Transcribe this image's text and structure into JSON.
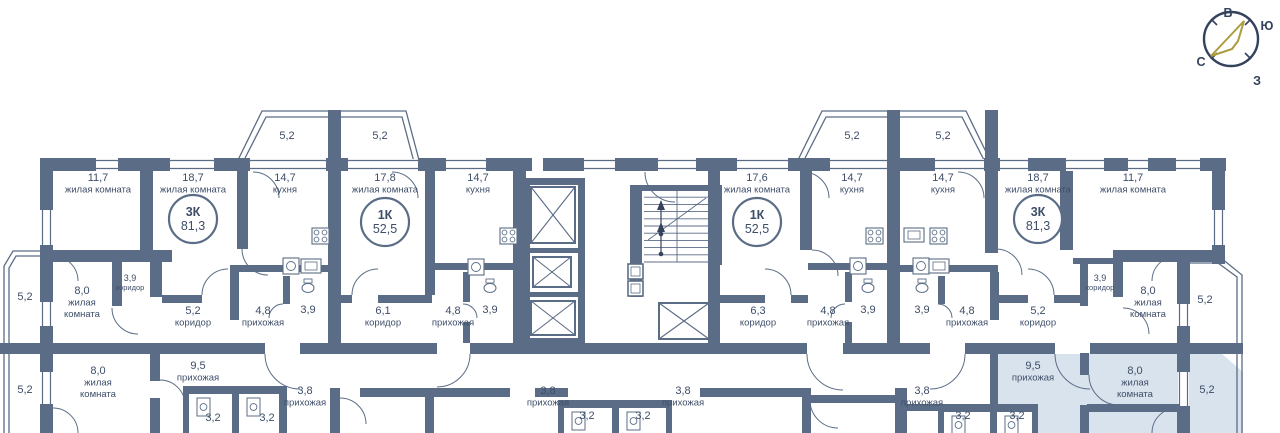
{
  "colors": {
    "wall": "#5b6d86",
    "text": "#3e4d68",
    "highlight": "#d9e3ee",
    "gold": "#ac9c3d",
    "compass": "#34425c",
    "white": "#ffffff"
  },
  "compass": {
    "cx": 1231,
    "cy": 39,
    "r": 27,
    "letters": [
      {
        "t": "В",
        "x": 1228,
        "y": 17
      },
      {
        "t": "Ю",
        "x": 1267,
        "y": 30
      },
      {
        "t": "С",
        "x": 1201,
        "y": 66
      },
      {
        "t": "З",
        "x": 1257,
        "y": 85
      }
    ],
    "ticks": [
      [
        1245,
        25,
        1251,
        19
      ],
      [
        1217,
        25,
        1211,
        19
      ],
      [
        1245,
        53,
        1251,
        59
      ],
      [
        1217,
        53,
        1211,
        59
      ]
    ],
    "arrow": "M1244,21 L1211,56 L1232,49 L1238,41 Z"
  },
  "apartments": [
    {
      "type": "3К",
      "area": "81,3",
      "cx": 193,
      "cy": 219
    },
    {
      "type": "1К",
      "area": "52,5",
      "cx": 385,
      "cy": 222
    },
    {
      "type": "1К",
      "area": "52,5",
      "cx": 757,
      "cy": 222
    },
    {
      "type": "3К",
      "area": "81,3",
      "cx": 1038,
      "cy": 219
    }
  ],
  "rooms": [
    {
      "x": 287,
      "y": 139,
      "l": [
        "5,2"
      ]
    },
    {
      "x": 380,
      "y": 139,
      "l": [
        "5,2"
      ]
    },
    {
      "x": 852,
      "y": 139,
      "l": [
        "5,2"
      ]
    },
    {
      "x": 943,
      "y": 139,
      "l": [
        "5,2"
      ]
    },
    {
      "x": 98,
      "y": 181,
      "l": [
        "11,7",
        "жилая комната"
      ]
    },
    {
      "x": 193,
      "y": 181,
      "l": [
        "18,7",
        "жилая комната"
      ]
    },
    {
      "x": 285,
      "y": 181,
      "l": [
        "14,7",
        "кухня"
      ]
    },
    {
      "x": 385,
      "y": 181,
      "l": [
        "17,8",
        "жилая комната"
      ]
    },
    {
      "x": 478,
      "y": 181,
      "l": [
        "14,7",
        "кухня"
      ]
    },
    {
      "x": 757,
      "y": 181,
      "l": [
        "17,6",
        "жилая комната"
      ]
    },
    {
      "x": 852,
      "y": 181,
      "l": [
        "14,7",
        "кухня"
      ]
    },
    {
      "x": 943,
      "y": 181,
      "l": [
        "14,7",
        "кухня"
      ]
    },
    {
      "x": 1038,
      "y": 181,
      "l": [
        "18,7",
        "жилая комната"
      ]
    },
    {
      "x": 1133,
      "y": 181,
      "l": [
        "11,7",
        "жилая комната"
      ]
    },
    {
      "x": 25,
      "y": 300,
      "l": [
        "5,2"
      ]
    },
    {
      "x": 82,
      "y": 294,
      "l": [
        "8,0",
        "жилая",
        "комната"
      ]
    },
    {
      "x": 130,
      "y": 281,
      "l": [
        "3,9",
        "коридор"
      ],
      "s": 1
    },
    {
      "x": 193,
      "y": 314,
      "l": [
        "5,2",
        "коридор"
      ]
    },
    {
      "x": 263,
      "y": 314,
      "l": [
        "4,8",
        "прихожая"
      ]
    },
    {
      "x": 308,
      "y": 313,
      "l": [
        "3,9"
      ]
    },
    {
      "x": 383,
      "y": 314,
      "l": [
        "6,1",
        "коридор"
      ]
    },
    {
      "x": 453,
      "y": 314,
      "l": [
        "4,8",
        "прихожая"
      ]
    },
    {
      "x": 490,
      "y": 313,
      "l": [
        "3,9"
      ]
    },
    {
      "x": 758,
      "y": 314,
      "l": [
        "6,3",
        "коридор"
      ]
    },
    {
      "x": 828,
      "y": 314,
      "l": [
        "4,8",
        "прихожая"
      ]
    },
    {
      "x": 868,
      "y": 313,
      "l": [
        "3,9"
      ]
    },
    {
      "x": 922,
      "y": 313,
      "l": [
        "3,9"
      ]
    },
    {
      "x": 967,
      "y": 314,
      "l": [
        "4,8",
        "прихожая"
      ]
    },
    {
      "x": 1038,
      "y": 314,
      "l": [
        "5,2",
        "коридор"
      ]
    },
    {
      "x": 1100,
      "y": 281,
      "l": [
        "3,9",
        "коридор"
      ],
      "s": 1
    },
    {
      "x": 1148,
      "y": 294,
      "l": [
        "8,0",
        "жилая",
        "комната"
      ]
    },
    {
      "x": 1205,
      "y": 303,
      "l": [
        "5,2"
      ]
    },
    {
      "x": 25,
      "y": 393,
      "l": [
        "5,2"
      ]
    },
    {
      "x": 98,
      "y": 374,
      "l": [
        "8,0",
        "жилая",
        "комната"
      ]
    },
    {
      "x": 198,
      "y": 369,
      "l": [
        "9,5",
        "прихожая"
      ]
    },
    {
      "x": 213,
      "y": 421,
      "l": [
        "3,2"
      ]
    },
    {
      "x": 267,
      "y": 421,
      "l": [
        "3,2"
      ]
    },
    {
      "x": 305,
      "y": 394,
      "l": [
        "3,8",
        "прихожая"
      ]
    },
    {
      "x": 548,
      "y": 394,
      "l": [
        "3,8",
        "прихожая"
      ]
    },
    {
      "x": 587,
      "y": 419,
      "l": [
        "3,2"
      ]
    },
    {
      "x": 643,
      "y": 419,
      "l": [
        "3,2"
      ]
    },
    {
      "x": 683,
      "y": 394,
      "l": [
        "3,8",
        "прихожая"
      ]
    },
    {
      "x": 922,
      "y": 394,
      "l": [
        "3,8",
        "прихожая"
      ]
    },
    {
      "x": 963,
      "y": 419,
      "l": [
        "3,2"
      ]
    },
    {
      "x": 1017,
      "y": 419,
      "l": [
        "3,2"
      ]
    },
    {
      "x": 1033,
      "y": 369,
      "l": [
        "9,5",
        "прихожая"
      ]
    },
    {
      "x": 1135,
      "y": 374,
      "l": [
        "8,0",
        "жилая",
        "комната"
      ]
    },
    {
      "x": 1207,
      "y": 393,
      "l": [
        "5,2"
      ]
    }
  ],
  "plan": {
    "highlight": "M990,354 L1222,354 L1243,372 L1243,433 L990,433 Z",
    "outlines": [
      "M238,160 L262,111 L406,111 L419,160",
      "M243,162 L266,117 L402,117 L414,162",
      "M798,160 L822,111 L966,111 L990,160",
      "M803,162 L826,117 L962,117 L985,162",
      "M43,251 L13,251 L4,266 L4,433",
      "M43,256 L16,256 L9,268 L9,433",
      "M1188,258 L1221,258 L1242,275 L1242,433",
      "M1188,263 L1218,263 L1237,277 L1237,433"
    ],
    "windows": [
      [
        96,
        159,
        22,
        11
      ],
      [
        170,
        159,
        44,
        11
      ],
      [
        250,
        159,
        76,
        11
      ],
      [
        348,
        159,
        70,
        11
      ],
      [
        446,
        159,
        40,
        11
      ],
      [
        584,
        159,
        31,
        11
      ],
      [
        658,
        159,
        38,
        11
      ],
      [
        737,
        159,
        51,
        11
      ],
      [
        830,
        159,
        60,
        11
      ],
      [
        935,
        159,
        49,
        11
      ],
      [
        1000,
        159,
        28,
        11
      ],
      [
        1066,
        159,
        38,
        11
      ],
      [
        1128,
        159,
        20,
        11
      ],
      [
        1176,
        159,
        24,
        11
      ],
      [
        41,
        210,
        11,
        36
      ],
      [
        41,
        297,
        11,
        29
      ],
      [
        41,
        372,
        11,
        32
      ],
      [
        1213,
        210,
        11,
        35
      ],
      [
        1178,
        304,
        11,
        22
      ],
      [
        1178,
        372,
        11,
        34
      ]
    ],
    "walls": [
      [
        40,
        158,
        56,
        13
      ],
      [
        118,
        158,
        52,
        13
      ],
      [
        214,
        158,
        36,
        13
      ],
      [
        326,
        158,
        22,
        13
      ],
      [
        418,
        158,
        28,
        13
      ],
      [
        486,
        158,
        46,
        13
      ],
      [
        543,
        158,
        41,
        13
      ],
      [
        615,
        158,
        43,
        13
      ],
      [
        696,
        158,
        41,
        13
      ],
      [
        788,
        158,
        42,
        13
      ],
      [
        890,
        158,
        45,
        13
      ],
      [
        984,
        158,
        16,
        13
      ],
      [
        1028,
        158,
        38,
        13
      ],
      [
        1104,
        158,
        24,
        13
      ],
      [
        1148,
        158,
        28,
        13
      ],
      [
        1200,
        158,
        26,
        13
      ],
      [
        40,
        158,
        13,
        52
      ],
      [
        40,
        245,
        13,
        57
      ],
      [
        40,
        326,
        13,
        46
      ],
      [
        40,
        404,
        13,
        29
      ],
      [
        1212,
        158,
        13,
        52
      ],
      [
        1212,
        245,
        13,
        19
      ],
      [
        40,
        250,
        132,
        12
      ],
      [
        1113,
        250,
        112,
        12
      ],
      [
        1177,
        262,
        13,
        42
      ],
      [
        1177,
        326,
        13,
        46
      ],
      [
        1177,
        406,
        13,
        27
      ],
      [
        0,
        343,
        265,
        11
      ],
      [
        300,
        343,
        137,
        11
      ],
      [
        470,
        343,
        337,
        11
      ],
      [
        843,
        343,
        87,
        11
      ],
      [
        965,
        343,
        90,
        11
      ],
      [
        1090,
        343,
        153,
        11
      ],
      [
        140,
        171,
        13,
        79
      ],
      [
        237,
        171,
        11,
        78
      ],
      [
        328,
        110,
        13,
        233
      ],
      [
        425,
        171,
        10,
        124
      ],
      [
        513,
        171,
        13,
        172
      ],
      [
        708,
        171,
        12,
        172
      ],
      [
        800,
        171,
        12,
        79
      ],
      [
        887,
        110,
        13,
        233
      ],
      [
        985,
        110,
        13,
        143
      ],
      [
        1060,
        171,
        13,
        79
      ],
      [
        112,
        262,
        10,
        44
      ],
      [
        150,
        262,
        12,
        35
      ],
      [
        230,
        265,
        98,
        7
      ],
      [
        230,
        272,
        9,
        48
      ],
      [
        283,
        276,
        7,
        28
      ],
      [
        162,
        295,
        40,
        8
      ],
      [
        340,
        295,
        12,
        8
      ],
      [
        378,
        295,
        54,
        8
      ],
      [
        432,
        263,
        81,
        7
      ],
      [
        463,
        272,
        7,
        30
      ],
      [
        463,
        322,
        7,
        21
      ],
      [
        523,
        178,
        7,
        167
      ],
      [
        578,
        178,
        7,
        167
      ],
      [
        523,
        178,
        62,
        7
      ],
      [
        523,
        338,
        62,
        7
      ],
      [
        523,
        248,
        62,
        5
      ],
      [
        523,
        292,
        62,
        5
      ],
      [
        630,
        185,
        12,
        112
      ],
      [
        712,
        185,
        10,
        80
      ],
      [
        642,
        185,
        70,
        6
      ],
      [
        720,
        295,
        45,
        8
      ],
      [
        791,
        295,
        17,
        8
      ],
      [
        808,
        263,
        85,
        7
      ],
      [
        845,
        272,
        7,
        30
      ],
      [
        845,
        322,
        7,
        21
      ],
      [
        900,
        265,
        98,
        7
      ],
      [
        938,
        276,
        7,
        28
      ],
      [
        990,
        272,
        9,
        48
      ],
      [
        998,
        295,
        30,
        8
      ],
      [
        1054,
        295,
        26,
        8
      ],
      [
        1073,
        258,
        48,
        6
      ],
      [
        1080,
        262,
        8,
        44
      ],
      [
        1113,
        262,
        10,
        35
      ],
      [
        150,
        353,
        10,
        28
      ],
      [
        150,
        398,
        10,
        35
      ],
      [
        278,
        386,
        9,
        47
      ],
      [
        330,
        388,
        10,
        45
      ],
      [
        360,
        388,
        65,
        9
      ],
      [
        425,
        388,
        9,
        45
      ],
      [
        434,
        388,
        76,
        9
      ],
      [
        535,
        388,
        33,
        9
      ],
      [
        700,
        388,
        103,
        9
      ],
      [
        802,
        388,
        9,
        45
      ],
      [
        810,
        395,
        85,
        8
      ],
      [
        895,
        388,
        12,
        45
      ],
      [
        907,
        404,
        34,
        7
      ],
      [
        990,
        347,
        8,
        86
      ],
      [
        1080,
        353,
        9,
        22
      ],
      [
        1080,
        405,
        9,
        28
      ],
      [
        1087,
        404,
        93,
        8
      ]
    ],
    "arcs": [
      "M253,172 A26,26 0 0 1 279,198",
      "M392,172 A26,26 0 0 1 418,198",
      "M803,172 A26,26 0 0 1 829,198",
      "M958,172 A26,26 0 0 1 984,198",
      "M53,256 A25,25 0 0 1 78,281",
      "M53,408 A25,25 0 0 1 78,433",
      "M1177,256 A25,25 0 0 0 1152,281",
      "M1177,408 A25,25 0 0 0 1152,433",
      "M242,249 A26,26 0 0 0 268,275",
      "M996,249 A26,26 0 0 1 1022,275",
      "M812,250 A26,26 0 0 1 838,276",
      "M112,308 A26,26 0 0 0 138,334",
      "M1123,308 A26,26 0 0 1 1149,334",
      "M228,269 A26,26 0 0 0 202,295",
      "M1028,269 A26,26 0 0 1 1054,295",
      "M378,269 A26,26 0 0 0 352,295",
      "M765,269 A26,26 0 0 1 791,295",
      "M265,354 A35,35 0 0 0 300,389",
      "M470,354 A33,33 0 0 1 437,387",
      "M807,354 A36,36 0 0 0 843,390",
      "M965,354 A35,35 0 0 1 930,389",
      "M1055,354 A35,35 0 0 0 1090,389",
      "M1089,375 A30,30 0 0 0 1119,405",
      "M160,380 A25,25 0 0 1 185,405",
      "M340,398 A26,26 0 0 1 366,424",
      "M810,400 A28,28 0 0 0 838,428",
      "M645,172 A30,30 0 0 0 675,202",
      "M283,304 A14,14 0 0 0 269,318",
      "M463,304 A14,14 0 0 1 477,318",
      "M845,304 A14,14 0 0 0 831,318",
      "M938,304 A14,14 0 0 1 952,318"
    ],
    "lifts": [
      [
        531,
        187,
        44,
        56
      ],
      [
        533,
        257,
        38,
        30
      ],
      [
        531,
        301,
        44,
        34
      ],
      [
        659,
        303,
        50,
        36
      ]
    ],
    "shafts": [
      [
        628,
        264,
        15,
        15
      ],
      [
        628,
        281,
        15,
        15
      ]
    ],
    "stairs": {
      "x": 644,
      "y": 190,
      "w": 66,
      "h": 72,
      "steps": 10
    },
    "bath_pairs": [
      {
        "x": 183,
        "y": 386,
        "w": 102,
        "div": 52
      },
      {
        "x": 558,
        "y": 400,
        "w": 114,
        "div": 57
      },
      {
        "x": 938,
        "y": 404,
        "w": 100,
        "div": 55
      }
    ],
    "appliances": [
      {
        "t": "stove",
        "x": 312,
        "y": 228
      },
      {
        "t": "stove",
        "x": 500,
        "y": 228
      },
      {
        "t": "stove",
        "x": 866,
        "y": 228
      },
      {
        "t": "stove",
        "x": 930,
        "y": 228
      },
      {
        "t": "wash",
        "x": 283,
        "y": 258
      },
      {
        "t": "wash",
        "x": 468,
        "y": 259
      },
      {
        "t": "wash",
        "x": 850,
        "y": 258
      },
      {
        "t": "wash",
        "x": 913,
        "y": 258
      },
      {
        "t": "counter",
        "x": 301,
        "y": 259
      },
      {
        "t": "counter",
        "x": 929,
        "y": 259
      },
      {
        "t": "counter",
        "x": 904,
        "y": 228
      },
      {
        "t": "wc",
        "x": 308,
        "y": 288
      },
      {
        "t": "wc",
        "x": 490,
        "y": 288
      },
      {
        "t": "wc",
        "x": 868,
        "y": 288
      },
      {
        "t": "wc",
        "x": 922,
        "y": 288
      }
    ]
  }
}
